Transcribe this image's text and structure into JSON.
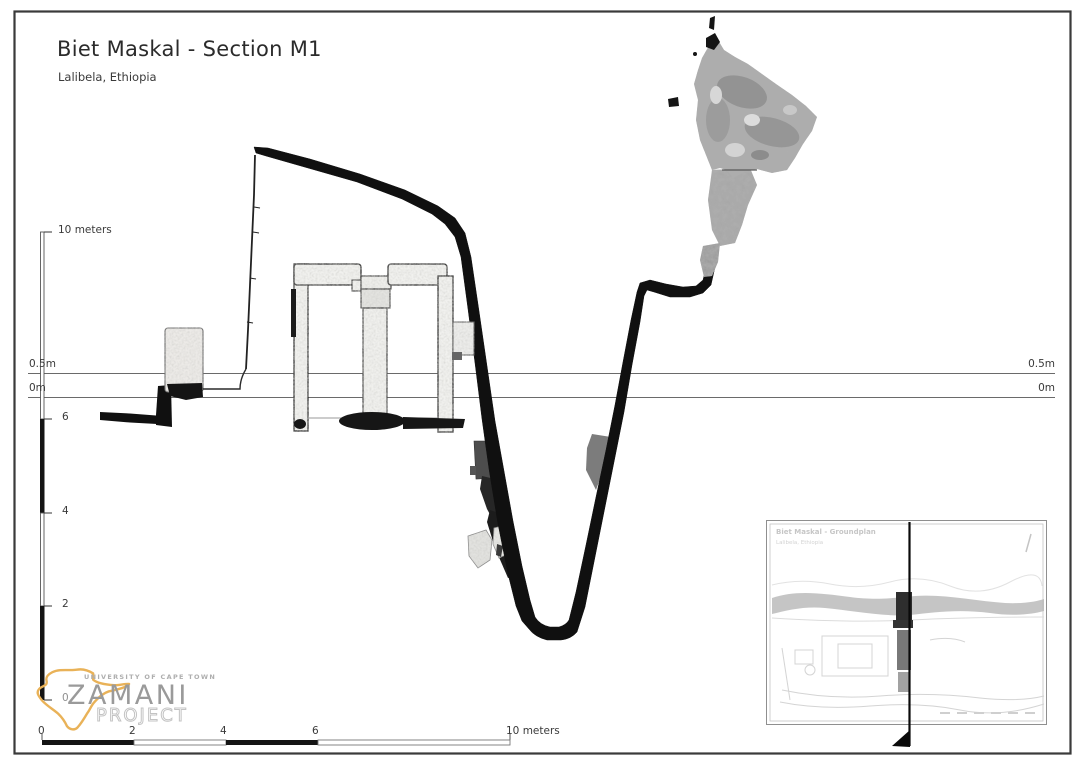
{
  "page": {
    "title": "Biet Maskal - Section M1",
    "subtitle": "Lalibela, Ethiopia"
  },
  "datum_lines": {
    "upper_label": "0.5m",
    "lower_label": "0m"
  },
  "vertical_scale": {
    "top_label": "10 meters",
    "tick_6": "6",
    "tick_4": "4",
    "tick_2": "2",
    "tick_0": "0"
  },
  "horizontal_scale": {
    "tick_0": "0",
    "tick_2": "2",
    "tick_4": "4",
    "tick_6": "6",
    "end_label": "10 meters"
  },
  "logo": {
    "university": "UNIVERSITY OF CAPE TOWN",
    "name": "ZAMANI",
    "name2": "PROJECT"
  },
  "inset": {
    "title": "Biet Maskal - Groundplan",
    "subtitle": "Lalibela, Ethiopia"
  },
  "colors": {
    "accent": "#E9B258",
    "ink": "#101010",
    "datum": "#666666",
    "logo-grey": "#9a9a9a"
  }
}
